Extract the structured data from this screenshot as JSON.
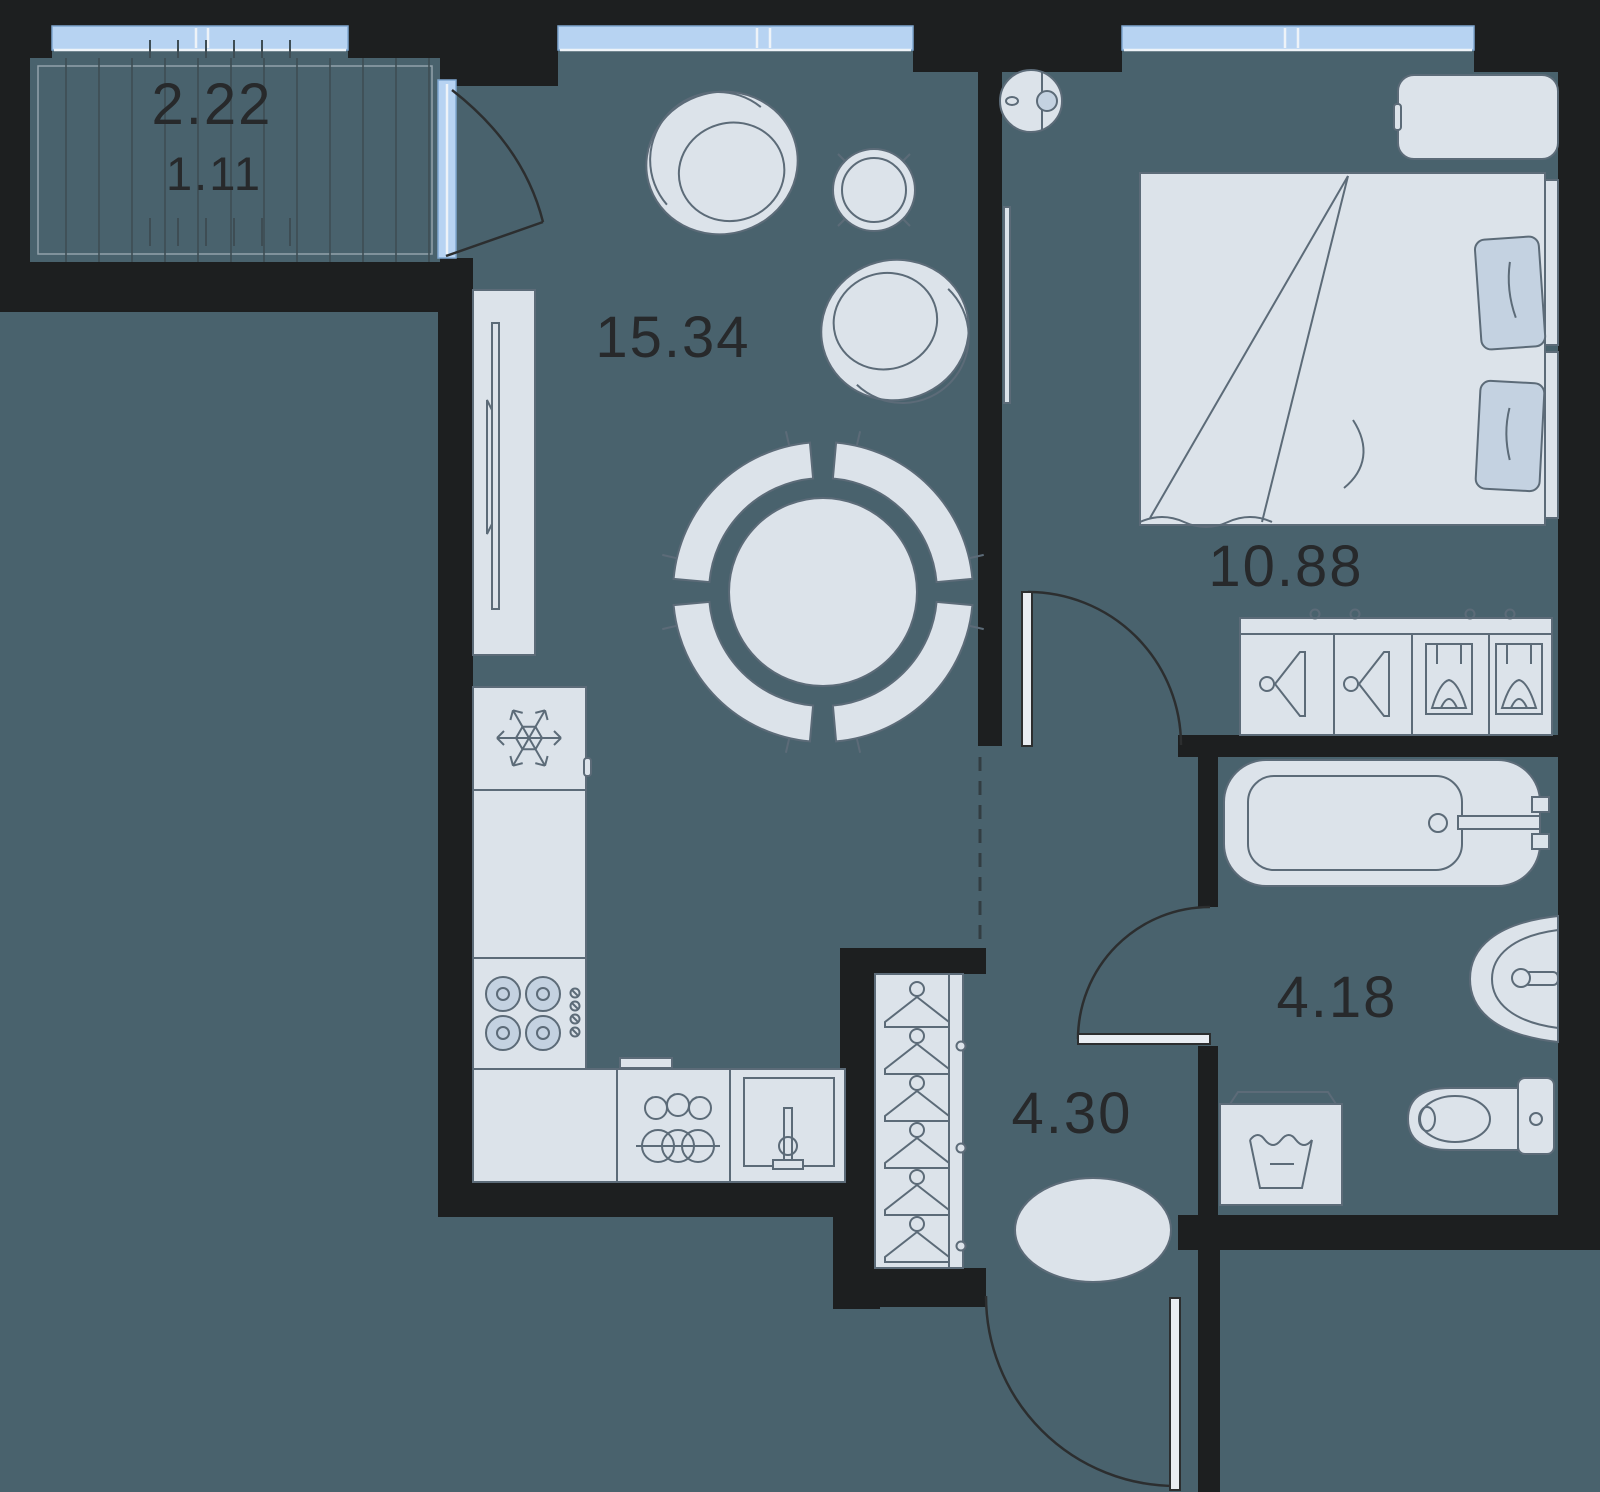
{
  "plan_title": "One-room apartment floor plan",
  "areas": {
    "living_kitchen": "15.34",
    "bedroom": "10.88",
    "bathroom": "4.18",
    "hallway": "4.30",
    "balcony_full": "2.22",
    "balcony_counted": "1.11"
  },
  "colors": {
    "background": "#49626d",
    "walls": "#1d1f20",
    "furniture_fill": "#dce3ea",
    "furniture_accent": "#c4d2e1",
    "furniture_stroke": "#5c6b78",
    "window_glass": "#b7d3f2",
    "label_text": "#27292b"
  },
  "furniture_icons": [
    "armchair-icon",
    "side-table-icon",
    "dining-table-icon",
    "dining-chair-icon",
    "tv-icon",
    "tv-stand-icon",
    "fridge-snowflake-icon",
    "stove-burners-icon",
    "dishwasher-icon",
    "kitchen-sink-icon",
    "bed-icon",
    "pillow-icon",
    "nightstand-icon",
    "robot-vacuum-icon",
    "dresser-hanger-icon",
    "folded-clothes-icon",
    "wardrobe-hanger-icon",
    "pouf-icon",
    "bathtub-icon",
    "washbasin-icon",
    "toilet-icon",
    "washing-machine-icon",
    "laundry-tub-icon"
  ]
}
